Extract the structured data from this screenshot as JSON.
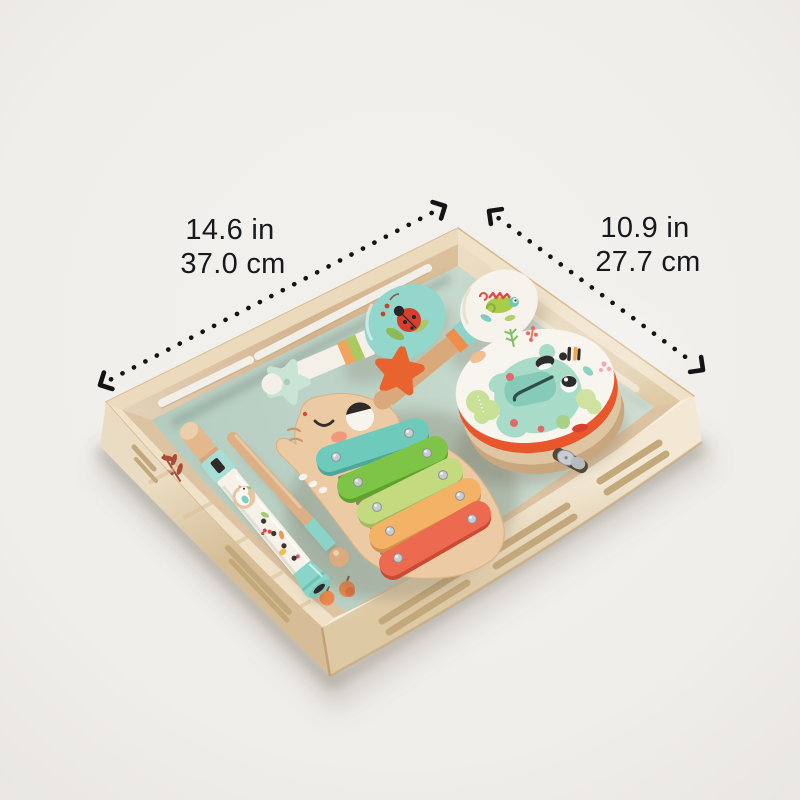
{
  "image": {
    "alt": "Wooden toy musical instrument set arranged in a light wooden slotted storage tray, shown with product dimension arrows",
    "background_color": "#f0eeea"
  },
  "annotations": {
    "width": {
      "inches": "14.6 in",
      "centimeters": "37.0 cm"
    },
    "depth": {
      "inches": "10.9 in",
      "centimeters": "27.7 cm"
    },
    "text_color": "#17191c",
    "arrow_color": "#141414"
  },
  "product": {
    "container": "wooden slotted tray with mint green mat",
    "instruments": [
      "teal maraca with ladybug print",
      "white maraca with chameleon print",
      "frog tambourine with metal jingle",
      "elephant xylophone with five bars",
      "bird recorder flute",
      "wooden drumstick with teal grip",
      "mint star castanet",
      "orange star castanet"
    ],
    "xylophone_bar_colors": [
      "#6ecabb",
      "#7dc447",
      "#c3da7e",
      "#f4b266",
      "#ec6a4f"
    ]
  },
  "palette": {
    "wood_light": "#efe2c9",
    "wood_tan": "#d9bf9d",
    "mat_green": "#c2d6ca",
    "teal": "#7fd1c5",
    "orange": "#f0954f",
    "coral": "#ec6a4f",
    "rim_orange": "#e8562c",
    "white_paint": "#f8f5ef"
  }
}
